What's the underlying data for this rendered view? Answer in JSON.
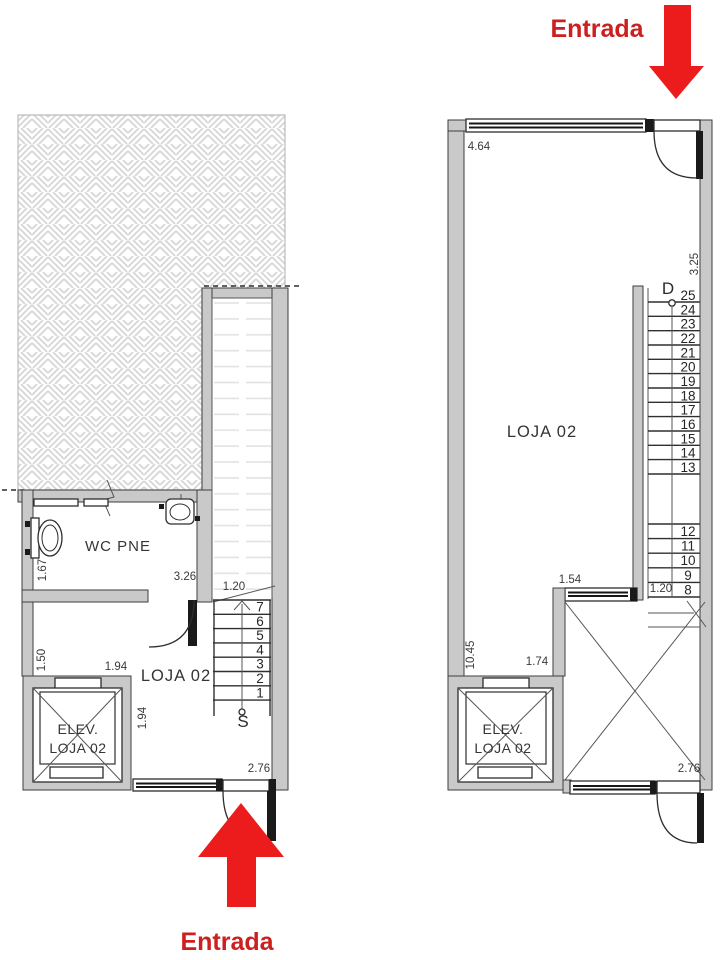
{
  "colors": {
    "accent_red": "#ec1c1c",
    "wall_gray": "#c9c9c9",
    "line_dark": "#2e2e2e"
  },
  "entrances": {
    "top_label": "Entrada",
    "bottom_label": "Entrada"
  },
  "left_plan": {
    "rooms": {
      "wc": "WC PNE",
      "loja": "LOJA 02",
      "elevator_line1": "ELEV.",
      "elevator_line2": "LOJA 02"
    },
    "stairs": {
      "direction_label": "S",
      "steps": [
        "7",
        "6",
        "5",
        "4",
        "3",
        "2",
        "1"
      ]
    },
    "dimensions": {
      "wc_height": "1.67",
      "wc_width": "3.26",
      "stair_width": "1.20",
      "elev_height": "1.50",
      "elev_width": "1.94",
      "elev_depth": "1.94",
      "door_width": "2.76"
    }
  },
  "right_plan": {
    "rooms": {
      "loja": "LOJA 02",
      "elevator_line1": "ELEV.",
      "elevator_line2": "LOJA 02"
    },
    "stairs": {
      "direction_label": "D",
      "steps_upper": [
        "25",
        "24",
        "23",
        "22",
        "21",
        "20",
        "19",
        "18",
        "17",
        "16",
        "15",
        "14",
        "13"
      ],
      "steps_lower": [
        "12",
        "11",
        "10",
        "9",
        "8"
      ]
    },
    "dimensions": {
      "top_width": "4.64",
      "right_depth": "3.25",
      "window_width": "1.54",
      "left_height": "10.45",
      "elev_width": "1.74",
      "stair_width": "1.20",
      "door_width": "2.76"
    }
  }
}
